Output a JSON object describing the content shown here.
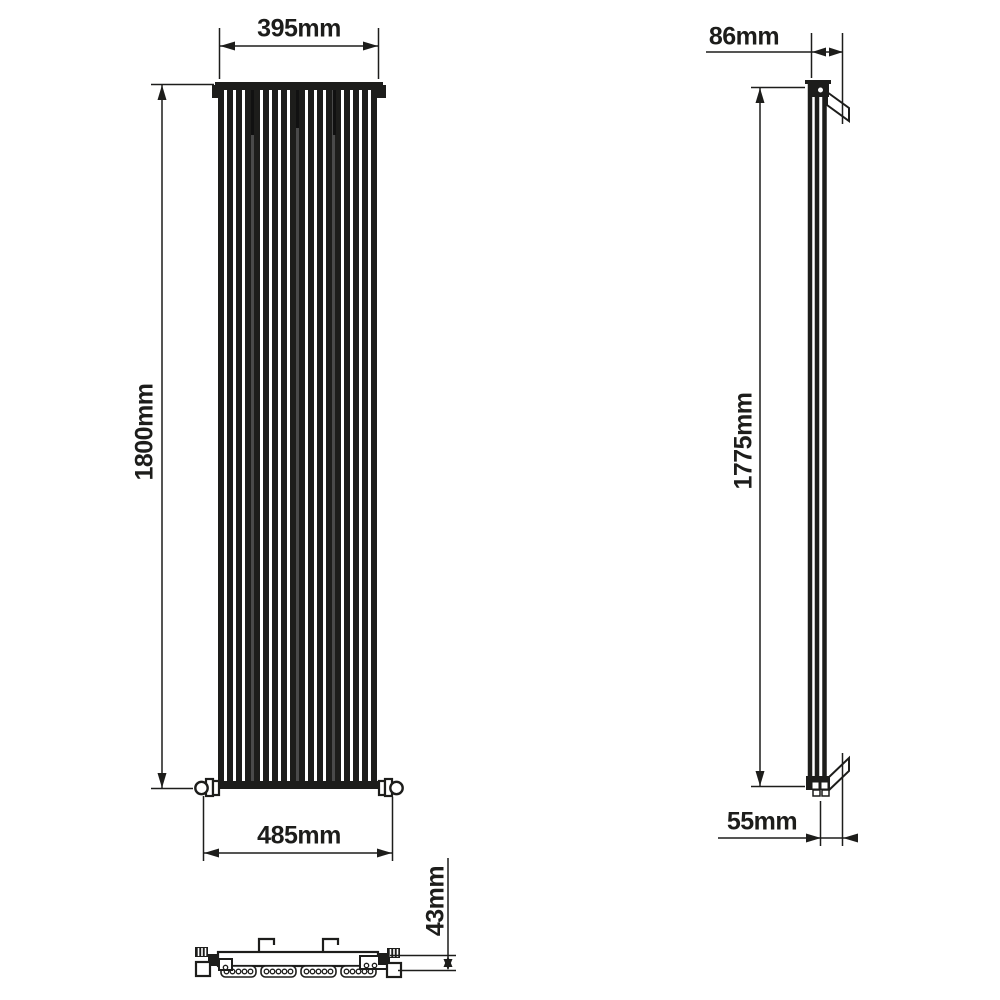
{
  "colors": {
    "line": "#1d1d1b",
    "section_joint": "#4a4a4a",
    "background": "#ffffff"
  },
  "dimensions": {
    "front_width_top": {
      "label": "395mm",
      "value_mm": 395
    },
    "front_height": {
      "label": "1800mm",
      "value_mm": 1800
    },
    "front_width_bottom": {
      "label": "485mm",
      "value_mm": 485
    },
    "side_depth_top": {
      "label": "86mm",
      "value_mm": 86
    },
    "side_height": {
      "label": "1775mm",
      "value_mm": 1775
    },
    "side_depth_wall": {
      "label": "55mm",
      "value_mm": 55
    },
    "plan_height": {
      "label": "43mm",
      "value_mm": 43
    }
  }
}
